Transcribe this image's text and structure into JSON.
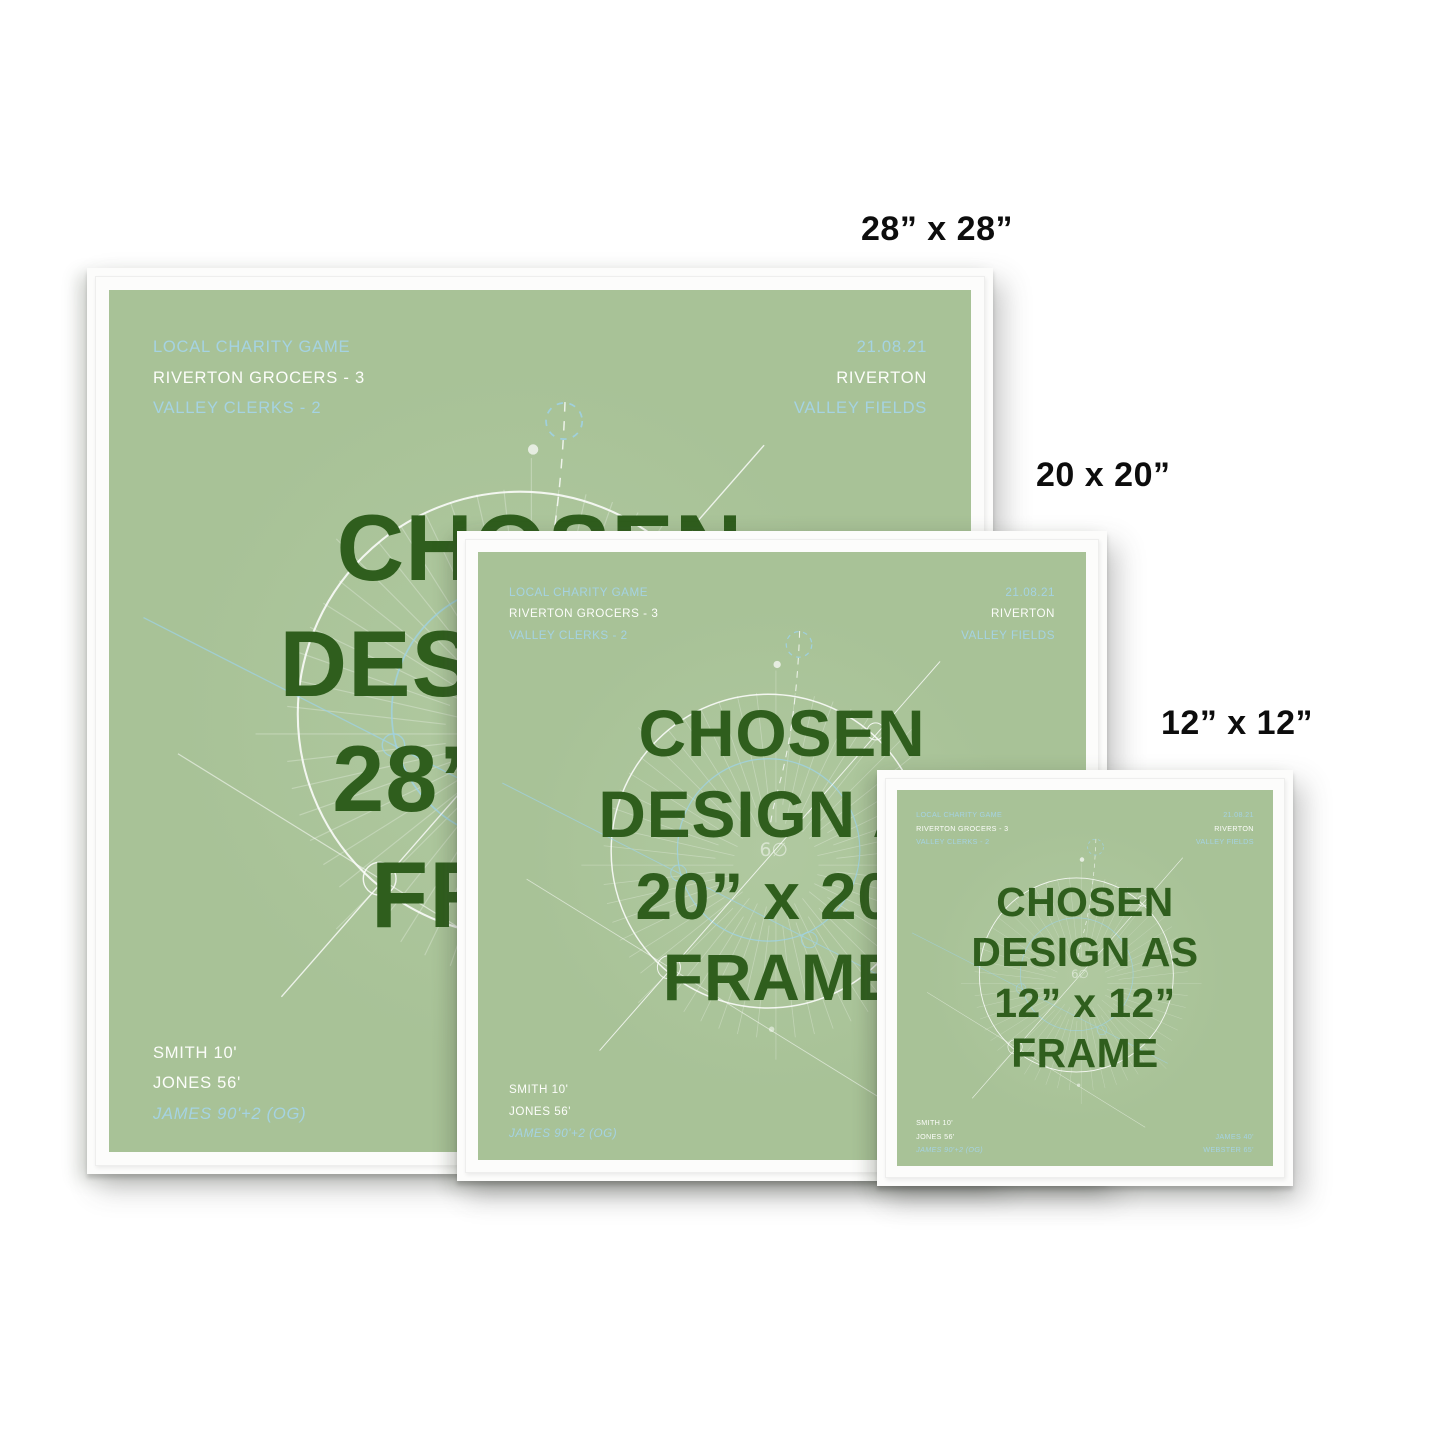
{
  "scene": {
    "background": "#ffffff"
  },
  "colors": {
    "poster_green": "#a8c297",
    "title_green": "#2f5e1d",
    "accent_blue": "#a5d3e2",
    "text_white": "#fcfdfa",
    "frame_white": "#fcfcfb",
    "label_black": "#0d0d0d"
  },
  "match": {
    "top_left": [
      "LOCAL CHARITY GAME",
      "RIVERTON GROCERS - 3",
      "VALLEY CLERKS - 2"
    ],
    "top_right": [
      "21.08.21",
      "RIVERTON",
      "VALLEY FIELDS"
    ],
    "bottom_left": [
      "SMITH 10'",
      "JONES 56'",
      "JAMES 90'+2 (OG)"
    ],
    "bottom_right": [
      "JAMES 40'",
      "WEBSTER 65'"
    ]
  },
  "frames": [
    {
      "size_label": "28” x 28”",
      "title_lines": [
        "CHOSEN",
        "DESIGN AS",
        "28” x 28”",
        "FRAME"
      ]
    },
    {
      "size_label": "20 x 20”",
      "title_lines": [
        "CHOSEN",
        "DESIGN AS",
        "20” x 20”",
        "FRAME"
      ]
    },
    {
      "size_label": "12” x 12”",
      "title_lines": [
        "CHOSEN",
        "DESIGN AS",
        "12” x 12”",
        "FRAME"
      ]
    }
  ]
}
